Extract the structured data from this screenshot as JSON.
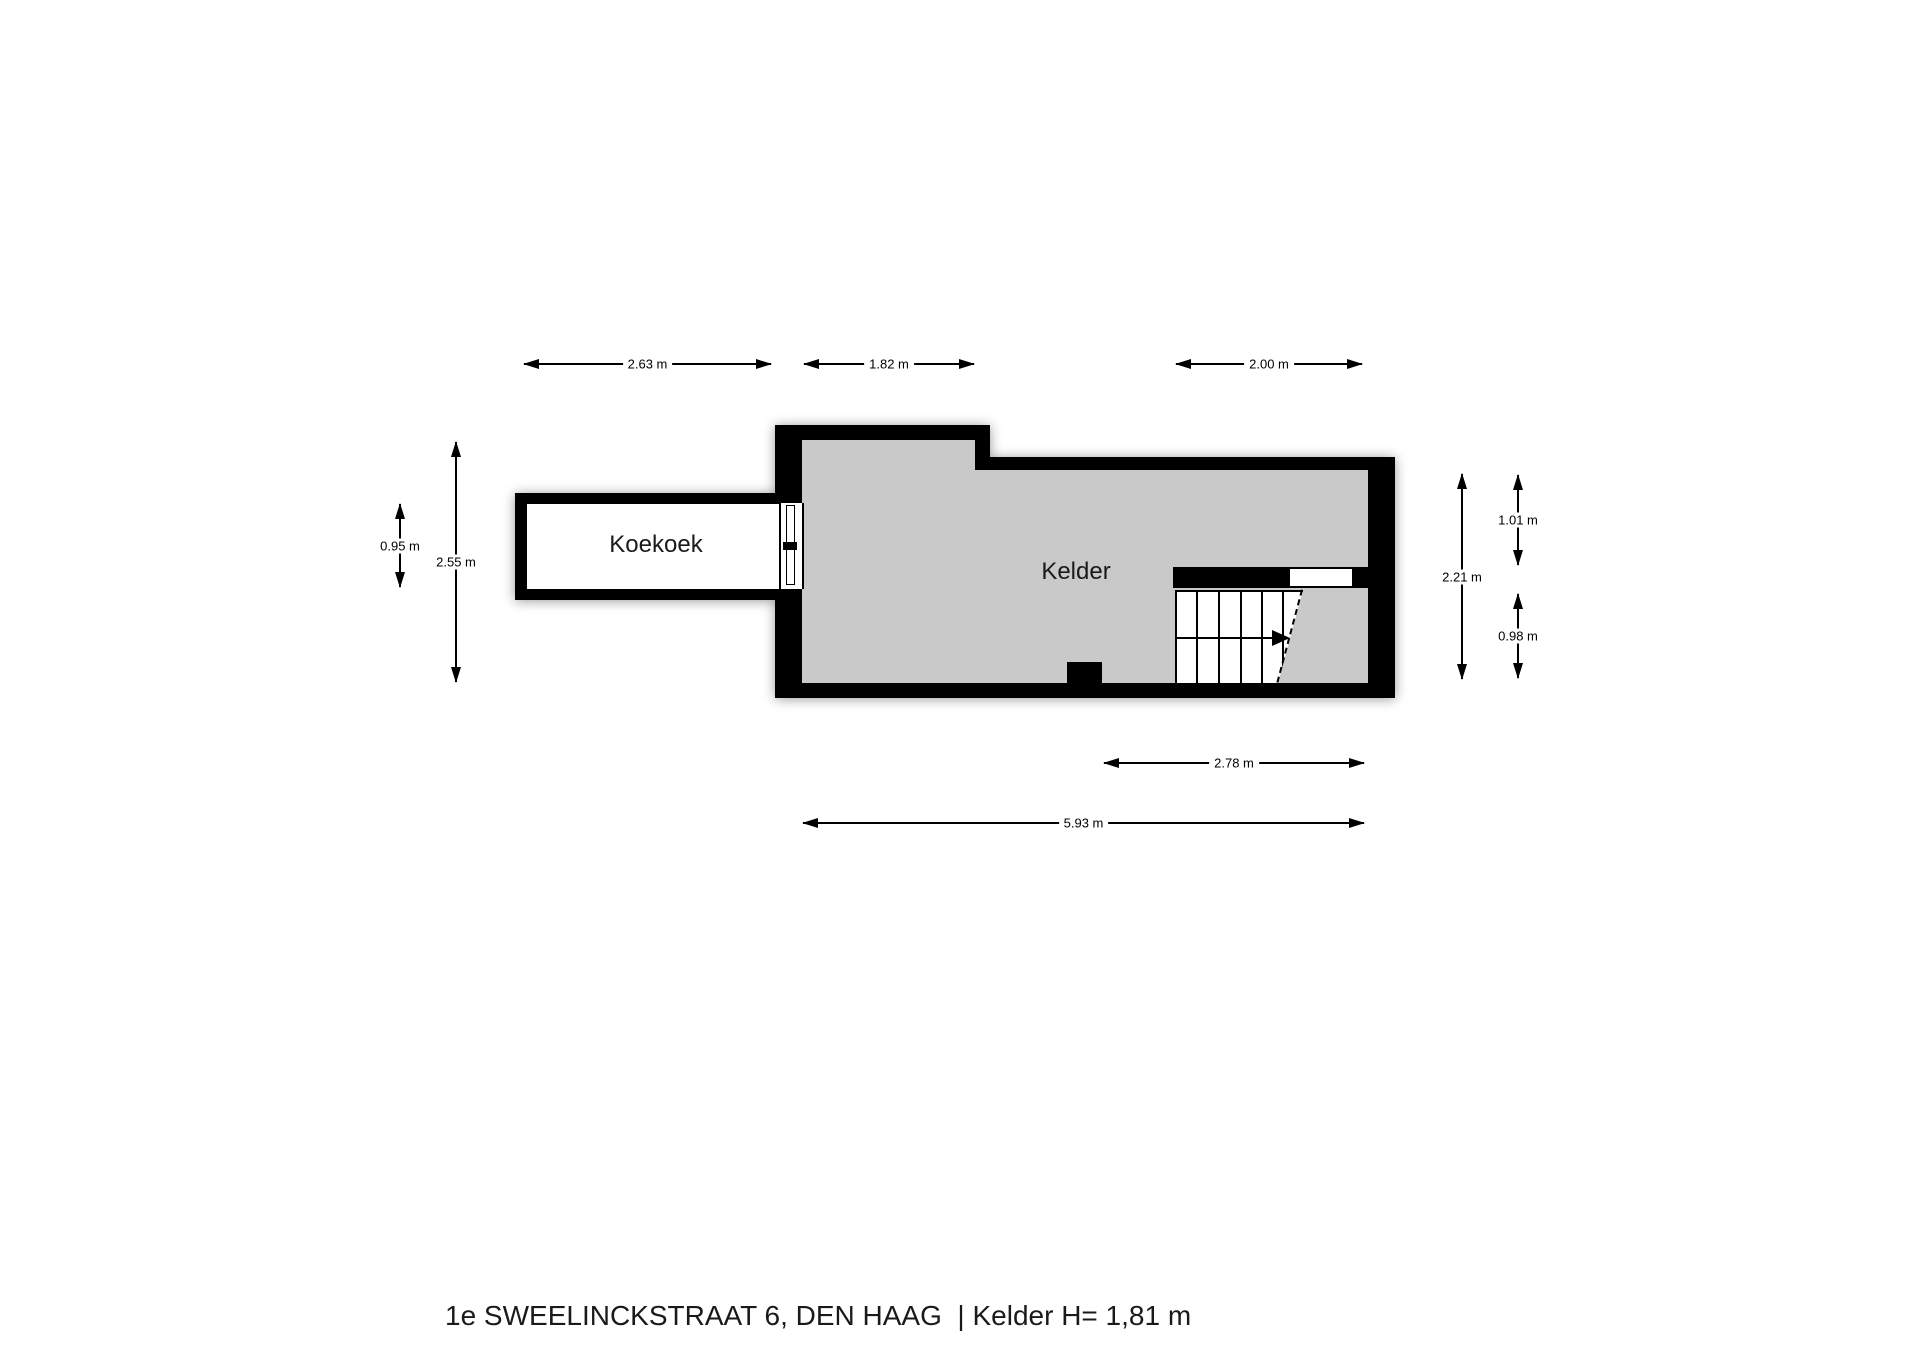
{
  "title": "1e SWEELINCKSTRAAT 6, DEN HAAG  | Kelder H= 1,81 m",
  "rooms": {
    "koekoek": "Koekoek",
    "kelder": "Kelder"
  },
  "dims": {
    "koekoek_width": "2.63 m",
    "nook_width": "1.82 m",
    "stairwell_width": "2.00 m",
    "koekoek_height": "0.95 m",
    "total_height": "2.55 m",
    "kelder_height": "2.21 m",
    "upper_right_height": "1.01 m",
    "lower_right_height": "0.98 m",
    "stair_span_width": "2.78 m",
    "kelder_width": "5.93 m"
  },
  "colors": {
    "wall": "#000000",
    "floor": "#c9c9c9",
    "background": "#ffffff",
    "text": "#1a1a1a"
  }
}
